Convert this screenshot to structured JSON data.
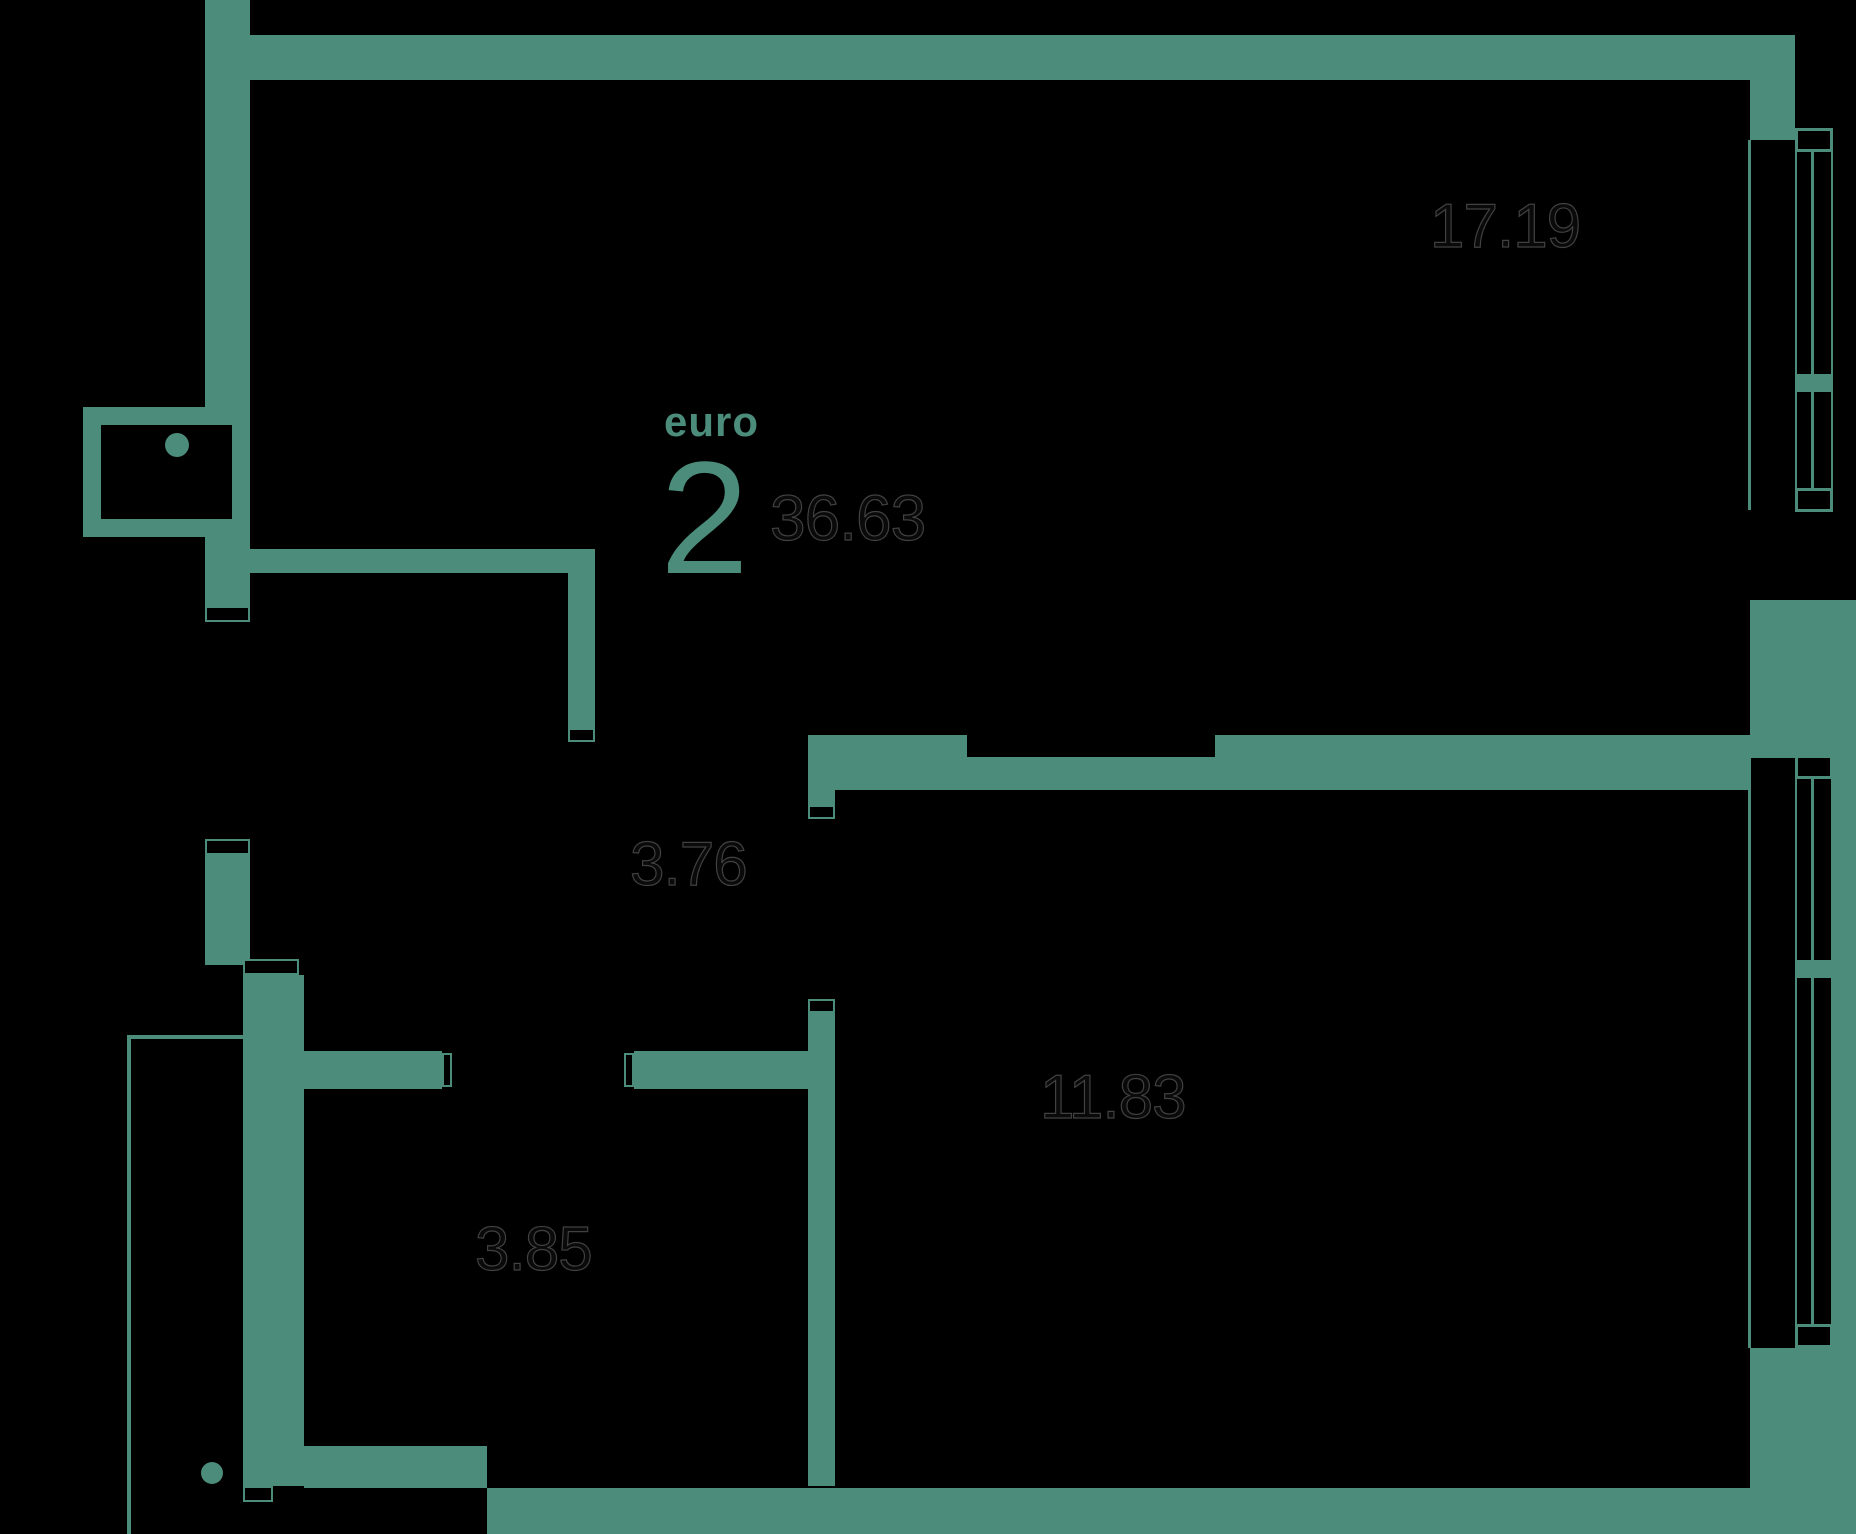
{
  "plan": {
    "background_color": "#000000",
    "wall_color": "#4B8C7A",
    "area_text_color": "#0a0a0a",
    "area_text_outline_color": "#414141",
    "type_label": "euro",
    "rooms_count": "2",
    "total_area": "36.63",
    "room_areas": {
      "living_room": "17.19",
      "hallway": "3.76",
      "bedroom": "11.83",
      "bathroom": "3.85"
    }
  }
}
